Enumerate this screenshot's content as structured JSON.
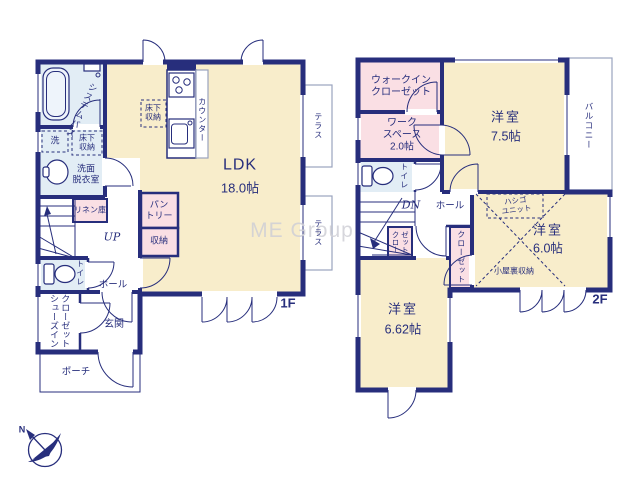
{
  "watermark": "ME Group",
  "compass": {
    "north_label": "N"
  },
  "colors": {
    "wall_navy": "#272e7c",
    "room_cream": "#f8edcb",
    "room_pink": "#fadfe4",
    "room_blue": "#e2edf5",
    "outline_gray": "#9aa3bd",
    "watermark_gray": "#cfcfd6"
  },
  "floor1": {
    "floor_label": "1F",
    "ldk_name": "LDK",
    "ldk_size": "18.0帖",
    "bath": "システムバス",
    "washer": "洗",
    "underfloor_storage_bath": "床下\n収納",
    "washroom": "洗面\n脱衣室",
    "linen_closet": "リネン庫",
    "stairs_up": "UP",
    "toilet": "トイレ",
    "hall": "ホール",
    "shoes_in_closet": "シューズイン\nクローゼット",
    "entrance": "玄関",
    "porch": "ポーチ",
    "underfloor_storage_kitchen": "床下\n収納",
    "counter": "カウンター",
    "pantry": "パン\nトリー",
    "storage": "収納",
    "terrace_upper": "テラス",
    "terrace_lower": "テラス"
  },
  "floor2": {
    "floor_label": "2F",
    "walk_in_closet": "ウォークイン\nクローゼット",
    "workspace": "ワーク\nスペース\n2.0帖",
    "toilet": "トイレ",
    "stairs_down": "DN",
    "hall": "ホール",
    "closet_a": "クロー\nゼット",
    "closet_b": "クローゼット",
    "room1_name": "洋室",
    "room1_size": "7.5帖",
    "room2_name": "洋室",
    "room2_size": "6.0帖",
    "room3_name": "洋室",
    "room3_size": "6.62帖",
    "balcony": "バルコニー",
    "ladder_unit": "ハシゴ\nユニット",
    "attic_storage": "小屋裏収納"
  }
}
